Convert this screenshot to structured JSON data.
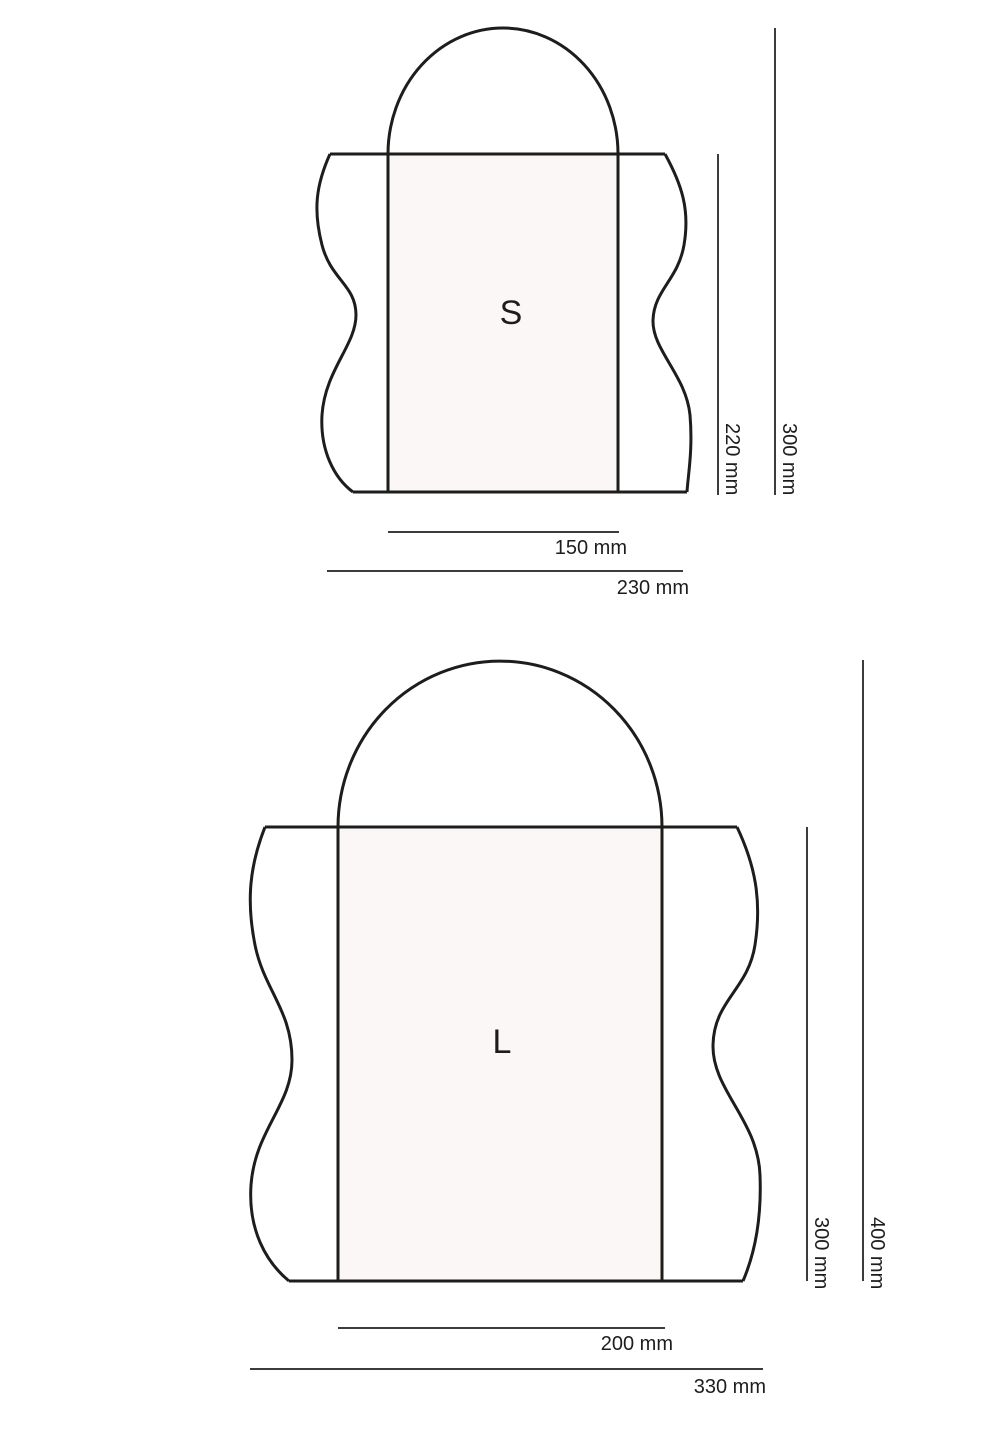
{
  "colors": {
    "background": "#ffffff",
    "outline": "#1d1d1b",
    "dimension_line": "#3c3c3c",
    "bag_fill": "#faf7f6",
    "text": "#1d1d1b"
  },
  "figures": {
    "small": {
      "label": "S",
      "dimensions": {
        "bag_height": "220 mm",
        "total_height": "300 mm",
        "bag_width": "150 mm",
        "fabric_width": "230 mm"
      }
    },
    "large": {
      "label": "L",
      "dimensions": {
        "bag_height": "300 mm",
        "total_height": "400 mm",
        "bag_width": "200 mm",
        "fabric_width": "330 mm"
      }
    }
  }
}
